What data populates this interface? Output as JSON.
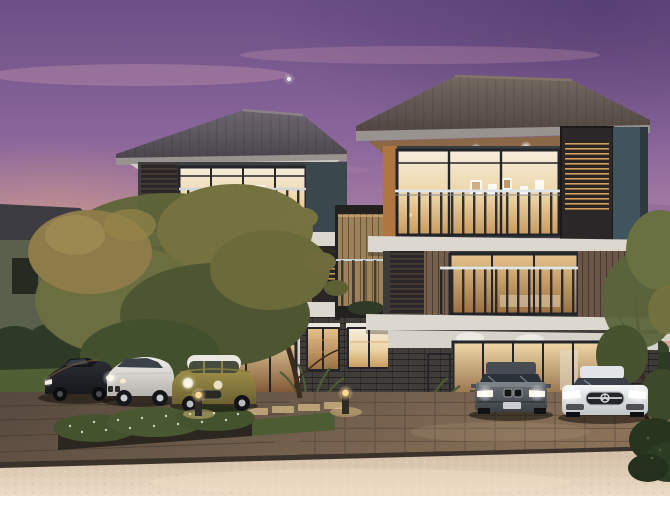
{
  "scene": {
    "description": "Dusk architectural rendering of a pair of modern three-storey townhouses with warm lit interiors, timber slat screens and glass balconies, five parked cars, landscaped garden beds, a paved driveway and a light sandy street in the foreground, under a purple-pink sunset sky",
    "time_of_day": "dusk",
    "style": "photorealistic 3D exterior rendering, no visible text",
    "objects": [
      {
        "name": "sky",
        "details": "purple to pink-orange sunset gradient with thin clouds and a tiny moon"
      },
      {
        "name": "townhouse-left",
        "details": "three storeys, dark grey hip roof, timber slat screens, dark framed glass walls, balconies, warm interior lighting"
      },
      {
        "name": "townhouse-right",
        "details": "three storeys, brown hip roof, vertical timber cladding, glass sliders, balconies, warm interior lighting"
      },
      {
        "name": "privacy-fence",
        "details": "timber screen wall between the two second-floor balconies"
      },
      {
        "name": "background-house-left",
        "details": "olive-walled house with dark roof behind the hedge"
      },
      {
        "name": "background-house-right",
        "details": "grey-roofed two-storey house behind a white fence"
      },
      {
        "name": "tree-left",
        "details": "large olive-gold tree in front of the left unit"
      },
      {
        "name": "tree-right",
        "details": "slender tree at the right edge"
      },
      {
        "name": "hedges",
        "details": "dark clipped hedges on both sides"
      },
      {
        "name": "flower-shrubs",
        "details": "white-flowering shrub row, ferns and red flower beds"
      },
      {
        "name": "bollard-lights",
        "count": 2,
        "details": "small glowing garden path lights"
      },
      {
        "name": "car-sports-black",
        "details": "black low wedge sports car, leftmost"
      },
      {
        "name": "car-sedan-white",
        "details": "white sedan, three-quarter front view"
      },
      {
        "name": "car-hatch-olive",
        "details": "olive-gold compact hatchback with white roof and round headlights"
      },
      {
        "name": "car-sedan-grey",
        "details": "grey sedan facing the street, twin kidney grille"
      },
      {
        "name": "car-coupe-white",
        "details": "white sports coupe with wide dark grille and central star"
      },
      {
        "name": "driveway",
        "details": "dark wet-look paved driveway with paver grid and stepping pads"
      },
      {
        "name": "road",
        "details": "light sand-coloured street strip across the foreground"
      },
      {
        "name": "downlights",
        "details": "warm recessed downlights under eaves and floor slabs"
      }
    ]
  },
  "palette": {
    "border_white": "#ffffff",
    "sky_top": "#6b4f85",
    "sky_mauve": "#a87da3",
    "sky_pink": "#d49da1",
    "sky_peach": "#edbc94",
    "sky_glow": "#f6b770",
    "moon": "#efe9f4",
    "roof_left_top": "#6d6670",
    "roof_left_bottom": "#474349",
    "roof_right_top": "#746861",
    "roof_right_bottom": "#4e443e",
    "fascia": "#99938f",
    "soffit_wood": "#8a6746",
    "slab": "#dcd7cf",
    "wall_white": "#e5e0d8",
    "wall_teal": "#3f545c",
    "wall_teal_dark": "#3a474c",
    "wood_plank": "#75604d",
    "wood_plank_dark": "#6a5747",
    "wood_fence": "#9c8159",
    "slat_base": "#2b2728",
    "slat_glow": "#d2a05c",
    "frame_dark": "#23252a",
    "glass_warm_hi": "#f7eedd",
    "glass_warm_mid": "#ecd3a4",
    "glass_warm_lo": "#c89a5e",
    "glass_deep": "#7a5230",
    "brick": "#403c3a",
    "rail_silver": "#dfe5e8",
    "rail_dark": "#1d1f24",
    "hedge_dark": "#2c3a26",
    "grass": "#4e6034",
    "fern": "#4c5c31",
    "flower_red": "#7d3340",
    "flower_white": "#e8ecdc",
    "tree_olive": "#5f6539",
    "tree_gold": "#8d7c49",
    "tree_dark": "#4e5631",
    "trunk": "#3b2c1f",
    "bg_wall_olive": "#59604c",
    "bg_roof": "#3d3b42",
    "drive_dark": "#55483d",
    "drive_paver": "#8a7158",
    "grout": "#473a2f",
    "road_light": "#ecdcc6",
    "road_base": "#d2bda6",
    "curb": "#3a322b",
    "car_black": "#17181c",
    "car_white": "#eceeee",
    "car_olive": "#a39449",
    "car_grey": "#575d63",
    "light_warm": "#ffd98f"
  }
}
